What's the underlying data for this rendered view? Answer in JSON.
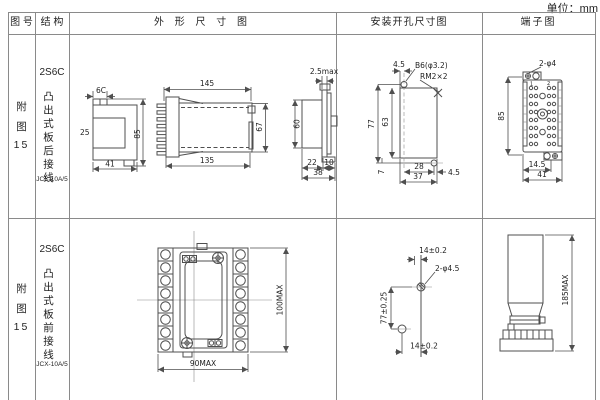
{
  "unit_label": "单位：mm",
  "header": {
    "fig_no": "图 号",
    "structure": "结 构",
    "outline": "外 形 尺 寸 图",
    "mounting": "安装开孔尺寸图",
    "terminal": "端子图"
  },
  "rows": [
    {
      "fig": {
        "c1": "附",
        "c2": "图",
        "c3": "15"
      },
      "structure": {
        "model": "2S6C",
        "type": "凸出式板后接线",
        "code": "JCX-10A/5"
      }
    },
    {
      "fig": {
        "c1": "附",
        "c2": "图",
        "c3": "15"
      },
      "structure": {
        "model": "2S6C",
        "type": "凸出式板前接线",
        "code": "JCX-10A/5"
      }
    }
  ],
  "drawings": {
    "row1": {
      "profile": {
        "top": "6C",
        "left": "25",
        "height": "85",
        "width": "41"
      },
      "side": {
        "top": "145",
        "bottom": "135",
        "height": "67"
      },
      "panel": {
        "top": "2.5max",
        "height": "60",
        "d1": "22",
        "d2": "10",
        "d3": "38"
      },
      "mount": {
        "offset_top": "4.5",
        "hole": "B6(φ3.2)",
        "screw": "RM2×2",
        "h_total": "77",
        "h_inner": "63",
        "h_foot": "7",
        "w_inner": "28",
        "w_total": "37",
        "offset_right": "4.5"
      },
      "terminal": {
        "holes": "2-φ4",
        "height": "85",
        "w1": "14.5",
        "w2": "41",
        "idx1": "1",
        "idx2": "2"
      }
    },
    "row2": {
      "front": {
        "width": "90MAX",
        "height": "100MAX"
      },
      "mount": {
        "top": "14±0.2",
        "holes": "2-φ4.5",
        "height": "77±0.25",
        "bottom": "14±0.2"
      },
      "terminal": {
        "height": "185MAX"
      }
    }
  }
}
